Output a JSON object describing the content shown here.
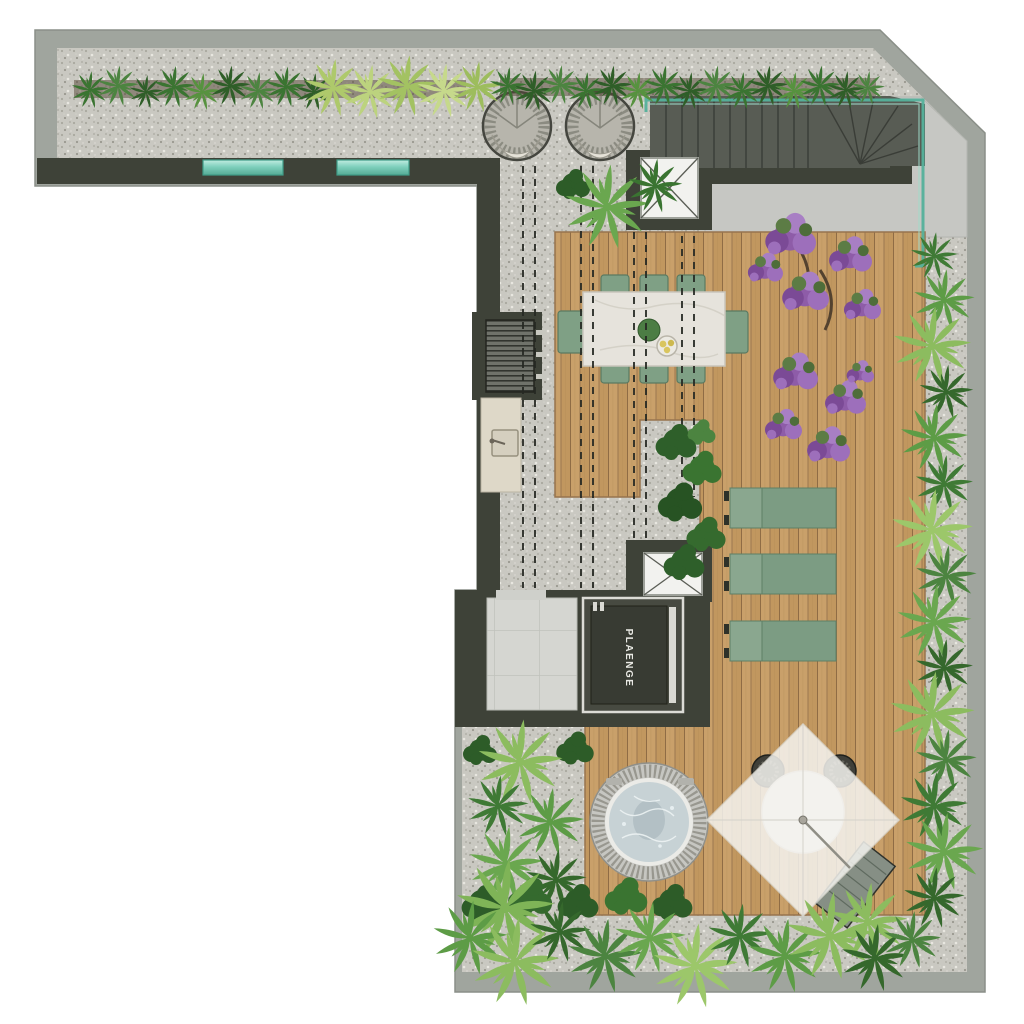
{
  "plan": {
    "brand_label": "PLAENGE",
    "areas": [
      "gravel-terrace",
      "wood-deck",
      "concrete-landing",
      "tile-lobby",
      "stair",
      "elevator-shaft",
      "skylight-shaft",
      "planting-beds"
    ],
    "furniture": [
      "hanging-egg-chair-x2",
      "dining-table-8-chairs",
      "sun-lounger-x3",
      "hot-tub",
      "parasol-dining-set",
      "deck-lounger",
      "outdoor-counter-sink",
      "equipment-grille"
    ],
    "colors": {
      "deck_wood": "#c7a06c",
      "gravel": "#c9c8c1",
      "wall_dark": "#3e4238",
      "wall_light": "#a0a59e",
      "concrete": "#c6c7c3",
      "glass_teal": "#6dbfa9",
      "upholstery_green": "#7fa085",
      "flower_purple": "#8e5ca8",
      "foliage_green": "#4c8440",
      "water": "#c7d2d5"
    }
  }
}
